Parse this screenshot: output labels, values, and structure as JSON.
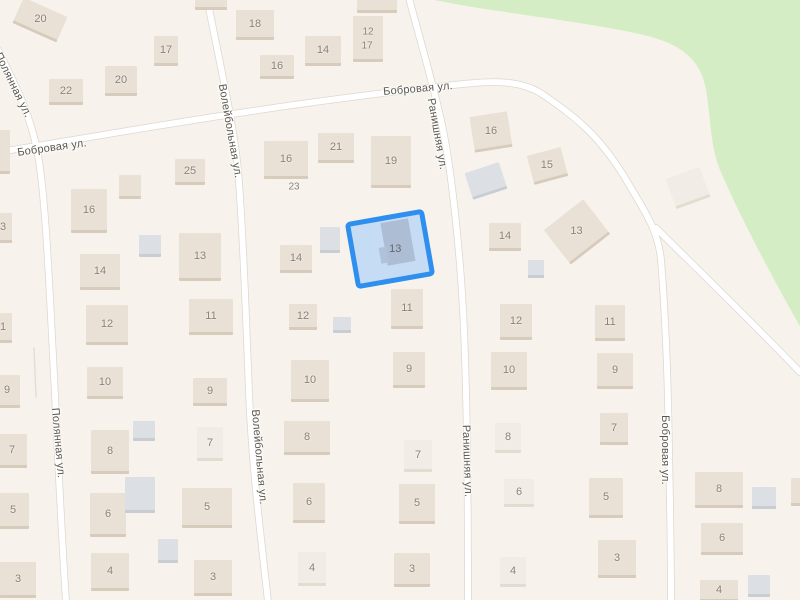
{
  "map": {
    "colors": {
      "land": "#f7f3ec",
      "green": "#d5edc4",
      "road_fill": "#ffffff",
      "road_casing": "#dcd7cf",
      "minor_path": "#e3dfd8",
      "beige": "#e9e1d6",
      "beige_shadow": "#d7cbbc",
      "pale": "#f1ece5",
      "pale_shadow": "#e3dcd1",
      "gray": "#dcdfe3",
      "gray_shadow": "#c8cdd4",
      "house_number": "#8b8278",
      "street_text": "#5b564e",
      "selection_border": "#2e8fee",
      "selection_fill": "#c6dcf4",
      "selection_building": "#b1c1d8",
      "selection_number": "#636871"
    },
    "green_area_path": "M430,-1 C490,12 560,18 630,32 C676,41 700,55 706,90 C711,120 710,145 720,170 C738,212 768,270 802,330 L802,-1 Z",
    "roads": [
      {
        "name": "Полянная ул.",
        "path": "M-2,50 C10,75 30,110 38,155 C46,200 50,300 55,395 C58,460 62,540 66,602"
      },
      {
        "name": "Волейбольная ул.",
        "path": "M207,-2 C218,55 233,120 238,170 C243,230 246,320 249,392 C252,470 262,545 268,602"
      },
      {
        "name": "Ранишняя ул.",
        "path": "M409,-2 C420,40 432,80 441,120 C452,170 461,260 464,330 C467,400 468,520 468,602"
      },
      {
        "name": "Бобровая ул.",
        "path": "M-2,152 C80,140 250,107 445,86 C490,81 520,78 545,96 C575,117 600,135 628,183 C645,212 658,230 661,260 C665,310 668,380 669,450 C670,500 671,560 671,602"
      },
      {
        "name": "Бобровая ул. (ответвление)",
        "path": "M656,228 C690,262 740,310 800,372"
      }
    ],
    "minor_paths": [
      "M34,348 L36,397",
      "M100,504 L103,533"
    ],
    "street_labels": [
      {
        "text": "Полянная ул.",
        "x": 13,
        "y": 85,
        "rot": 64
      },
      {
        "text": "Полянная ул.",
        "x": 58,
        "y": 443,
        "rot": 85
      },
      {
        "text": "Волейбольная ул.",
        "x": 230,
        "y": 131,
        "rot": 80
      },
      {
        "text": "Волейбольная ул.",
        "x": 259,
        "y": 457,
        "rot": 85
      },
      {
        "text": "Ранишняя ул.",
        "x": 437,
        "y": 134,
        "rot": 80
      },
      {
        "text": "Ранишняя ул.",
        "x": 467,
        "y": 461,
        "rot": 88
      },
      {
        "text": "Бобровая ул.",
        "x": 52,
        "y": 148,
        "rot": -8
      },
      {
        "text": "Бобровая ул.",
        "x": 418,
        "y": 89,
        "rot": -5
      },
      {
        "text": "Бобровая ул.",
        "x": 665,
        "y": 450,
        "rot": 90
      }
    ],
    "buildings_format": "[left, top, width, height, rotation_deg, type(b=beige,p=pale,g=gray), house_number]",
    "buildings": [
      [
        16,
        6,
        48,
        28,
        24,
        "b",
        "20"
      ],
      [
        49,
        79,
        34,
        26,
        0,
        "b",
        "22"
      ],
      [
        105,
        66,
        32,
        30,
        0,
        "b",
        "20"
      ],
      [
        154,
        36,
        24,
        30,
        0,
        "b",
        "17"
      ],
      [
        195,
        -4,
        32,
        14,
        0,
        "b",
        ""
      ],
      [
        236,
        10,
        38,
        30,
        0,
        "b",
        "18"
      ],
      [
        260,
        55,
        34,
        24,
        0,
        "b",
        "16"
      ],
      [
        305,
        36,
        36,
        30,
        0,
        "b",
        "14"
      ],
      [
        353,
        16,
        30,
        46,
        0,
        "b",
        ""
      ],
      [
        357,
        -2,
        40,
        15,
        0,
        "b",
        ""
      ],
      [
        -4,
        130,
        14,
        44,
        0,
        "b",
        ""
      ],
      [
        -6,
        213,
        18,
        30,
        0,
        "b",
        "3"
      ],
      [
        -6,
        313,
        18,
        30,
        0,
        "b",
        "1"
      ],
      [
        -6,
        375,
        26,
        33,
        0,
        "b",
        "9"
      ],
      [
        -3,
        434,
        30,
        34,
        0,
        "b",
        "7"
      ],
      [
        -3,
        493,
        32,
        36,
        0,
        "b",
        "5"
      ],
      [
        0,
        562,
        36,
        36,
        0,
        "b",
        "3"
      ],
      [
        175,
        159,
        30,
        26,
        0,
        "b",
        "25"
      ],
      [
        119,
        175,
        22,
        24,
        0,
        "b",
        ""
      ],
      [
        71,
        189,
        36,
        44,
        0,
        "b",
        "16"
      ],
      [
        139,
        235,
        22,
        22,
        0,
        "g",
        ""
      ],
      [
        179,
        233,
        42,
        48,
        0,
        "b",
        "13"
      ],
      [
        80,
        254,
        40,
        36,
        0,
        "b",
        "14"
      ],
      [
        86,
        305,
        42,
        40,
        0,
        "b",
        "12"
      ],
      [
        189,
        299,
        44,
        36,
        0,
        "b",
        "11"
      ],
      [
        87,
        367,
        36,
        32,
        0,
        "b",
        "10"
      ],
      [
        193,
        378,
        34,
        28,
        0,
        "b",
        "9"
      ],
      [
        91,
        430,
        38,
        44,
        0,
        "b",
        "8"
      ],
      [
        197,
        427,
        26,
        34,
        0,
        "p",
        "7"
      ],
      [
        133,
        421,
        22,
        20,
        0,
        "g",
        ""
      ],
      [
        90,
        493,
        36,
        44,
        0,
        "b",
        "6"
      ],
      [
        182,
        488,
        50,
        40,
        0,
        "b",
        "5"
      ],
      [
        125,
        477,
        30,
        36,
        0,
        "g",
        ""
      ],
      [
        158,
        539,
        20,
        24,
        0,
        "g",
        ""
      ],
      [
        91,
        553,
        38,
        38,
        0,
        "b",
        "4"
      ],
      [
        194,
        560,
        38,
        36,
        0,
        "b",
        "3"
      ],
      [
        264,
        141,
        44,
        38,
        0,
        "b",
        "16"
      ],
      [
        318,
        133,
        36,
        30,
        0,
        "b",
        "21"
      ],
      [
        371,
        136,
        40,
        52,
        0,
        "b",
        "19"
      ],
      [
        280,
        245,
        32,
        28,
        0,
        "b",
        "14"
      ],
      [
        320,
        227,
        20,
        26,
        0,
        "g",
        ""
      ],
      [
        289,
        304,
        28,
        26,
        0,
        "b",
        "12"
      ],
      [
        333,
        317,
        18,
        16,
        0,
        "g",
        ""
      ],
      [
        391,
        289,
        32,
        40,
        0,
        "b",
        "11"
      ],
      [
        291,
        360,
        38,
        42,
        0,
        "b",
        "10"
      ],
      [
        393,
        352,
        32,
        36,
        0,
        "b",
        "9"
      ],
      [
        284,
        421,
        46,
        34,
        0,
        "b",
        "8"
      ],
      [
        404,
        440,
        28,
        32,
        0,
        "p",
        "7"
      ],
      [
        293,
        483,
        32,
        40,
        0,
        "b",
        "6"
      ],
      [
        399,
        484,
        36,
        40,
        0,
        "b",
        "5"
      ],
      [
        298,
        552,
        28,
        34,
        0,
        "p",
        "4"
      ],
      [
        394,
        553,
        36,
        34,
        0,
        "b",
        "3"
      ],
      [
        472,
        114,
        38,
        36,
        -9,
        "b",
        "16"
      ],
      [
        468,
        167,
        36,
        28,
        -18,
        "g",
        ""
      ],
      [
        530,
        151,
        35,
        30,
        -15,
        "b",
        "15"
      ],
      [
        489,
        223,
        32,
        28,
        0,
        "b",
        "14"
      ],
      [
        552,
        210,
        50,
        44,
        -38,
        "b",
        "13"
      ],
      [
        528,
        260,
        16,
        18,
        0,
        "g",
        ""
      ],
      [
        500,
        304,
        32,
        36,
        0,
        "b",
        "12"
      ],
      [
        595,
        305,
        30,
        36,
        0,
        "b",
        "11"
      ],
      [
        491,
        352,
        36,
        38,
        0,
        "b",
        "10"
      ],
      [
        597,
        353,
        36,
        36,
        0,
        "b",
        "9"
      ],
      [
        495,
        423,
        26,
        30,
        0,
        "p",
        "8"
      ],
      [
        600,
        413,
        28,
        32,
        0,
        "b",
        "7"
      ],
      [
        504,
        479,
        30,
        28,
        0,
        "p",
        "6"
      ],
      [
        589,
        478,
        34,
        40,
        0,
        "b",
        "5"
      ],
      [
        500,
        557,
        26,
        30,
        0,
        "p",
        "4"
      ],
      [
        598,
        540,
        38,
        38,
        0,
        "b",
        "3"
      ],
      [
        670,
        172,
        36,
        32,
        -20,
        "p",
        ""
      ],
      [
        695,
        472,
        48,
        36,
        0,
        "b",
        "8"
      ],
      [
        701,
        523,
        42,
        32,
        0,
        "b",
        "6"
      ],
      [
        700,
        580,
        38,
        22,
        0,
        "b",
        "4"
      ],
      [
        752,
        487,
        24,
        22,
        0,
        "g",
        ""
      ],
      [
        748,
        575,
        22,
        22,
        0,
        "g",
        ""
      ],
      [
        791,
        478,
        14,
        28,
        0,
        "b",
        ""
      ]
    ],
    "standalone_labels": [
      {
        "text": "12",
        "x": 368,
        "y": 32
      },
      {
        "text": "17",
        "x": 367,
        "y": 46
      },
      {
        "text": "23",
        "x": 294,
        "y": 187
      }
    ],
    "selected_parcel": {
      "left": 350,
      "top": 215,
      "width": 80,
      "height": 68,
      "rot": -10,
      "building": {
        "left": 30,
        "top": 2,
        "width": 28,
        "height": 40
      },
      "building_foot": {
        "left": 24,
        "top": 26,
        "width": 8,
        "height": 16
      },
      "label": "13",
      "label_left": 34,
      "label_top": 24
    }
  }
}
